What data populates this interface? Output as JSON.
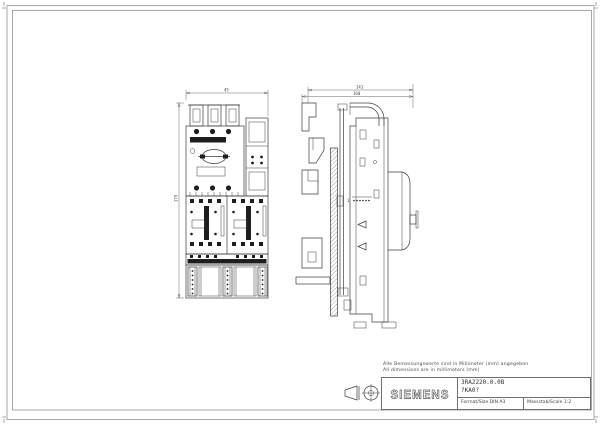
{
  "notes": {
    "line1": "Alle Bemessungswerte sind in Millimeter (mm) angegeben",
    "line2": "All dimensions are in millimeters (mm)"
  },
  "title_block": {
    "brand": "SIEMENS",
    "product": "3RA2220.0.0B",
    "order_code": "?KA0?",
    "format_label": "Format/Size DIN A3",
    "scale_label": "Massstab/Scale 1:2"
  },
  "dims": {
    "front_width": "45",
    "front_height": "170",
    "side_upper": "141",
    "side_total": "160"
  },
  "side_detail": {
    "label": "1"
  },
  "icons": {
    "projection_symbol": "first-angle-projection-icon"
  },
  "colors": {
    "line": "#3c3c3c",
    "frame": "#a8a8a8",
    "fill_dark": "#1e1e1e",
    "background": "#ffffff"
  }
}
